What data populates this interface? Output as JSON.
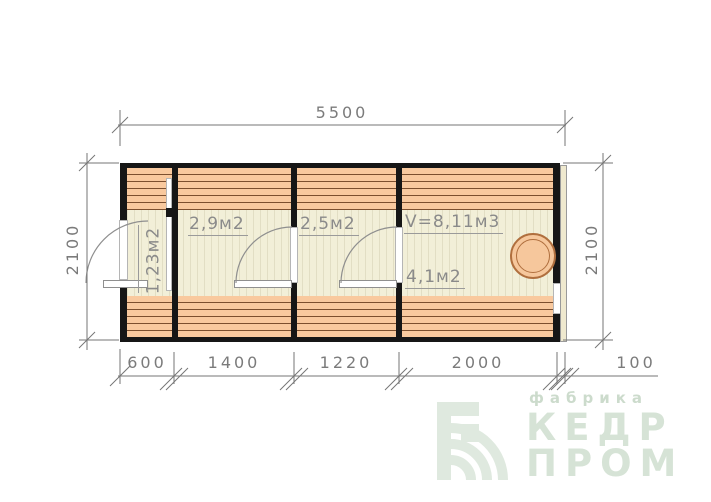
{
  "drawing": {
    "title": "floor plan 5500x2100 modular sauna",
    "dimensions": {
      "top": "5500",
      "left": "2100",
      "right": "2100",
      "bottom": [
        "600",
        "1400",
        "1220",
        "2000",
        "100"
      ]
    },
    "rooms": [
      {
        "area": "1,23м2"
      },
      {
        "area": "2,9м2"
      },
      {
        "area": "2,5м2"
      },
      {
        "volume": "V=8,11м3",
        "area": "4,1м2"
      }
    ]
  },
  "logo": {
    "tagline": "фабрика",
    "name_top": "КЕДР",
    "name_bottom": "ПРОМ"
  },
  "colors": {
    "wall": "#161616",
    "plank": "#f9c99e",
    "plank_line": "#7c4f2e",
    "floor": "#f2efd8",
    "dim_gray": "#7b7b7b",
    "label_gray": "#8a8a8a",
    "logo_green": "#d6e3d6",
    "stove_fill": "#f6c79c",
    "stove_stroke": "#b06f3e"
  }
}
